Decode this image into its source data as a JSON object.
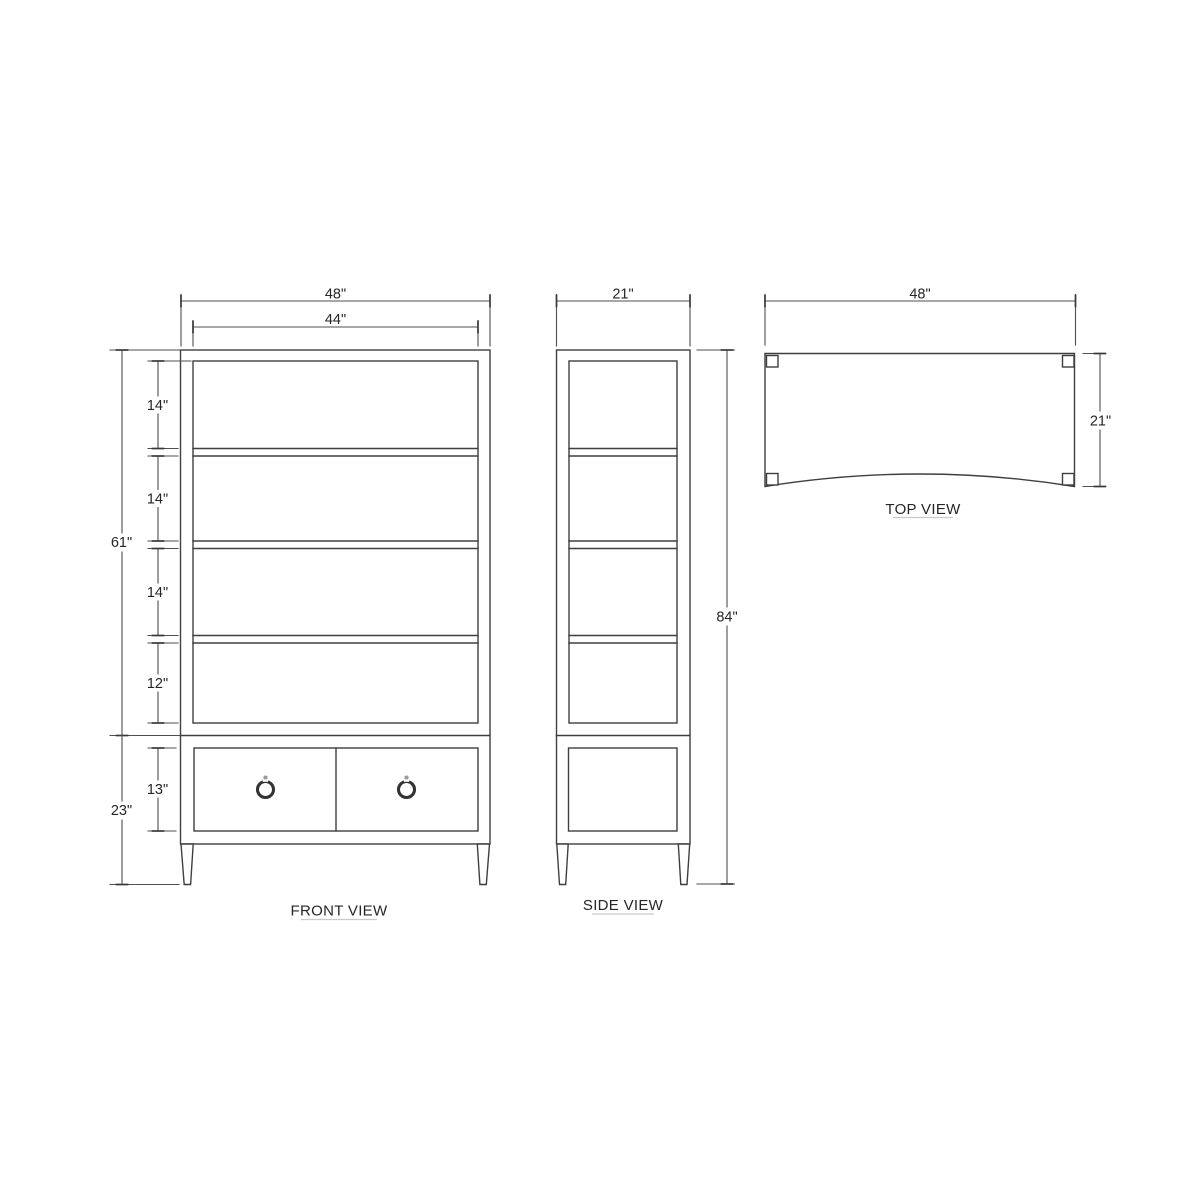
{
  "canvas": {
    "background": "#ffffff",
    "line_color": "#3f3f3f",
    "text_color": "#262626"
  },
  "front_view": {
    "label": "FRONT VIEW",
    "dim_overall_width": "48\"",
    "dim_opening_width": "44\"",
    "dim_upper_section_height": "61\"",
    "dim_shelf_opening_1": "14\"",
    "dim_shelf_opening_2": "14\"",
    "dim_shelf_opening_3": "14\"",
    "dim_shelf_opening_4": "12\"",
    "dim_base_section_height": "23\"",
    "dim_drawer_opening_height": "13\""
  },
  "side_view": {
    "label": "SIDE VIEW",
    "dim_depth": "21\"",
    "dim_overall_height": "84\""
  },
  "top_view": {
    "label": "TOP VIEW",
    "dim_width": "48\"",
    "dim_depth": "21\""
  }
}
